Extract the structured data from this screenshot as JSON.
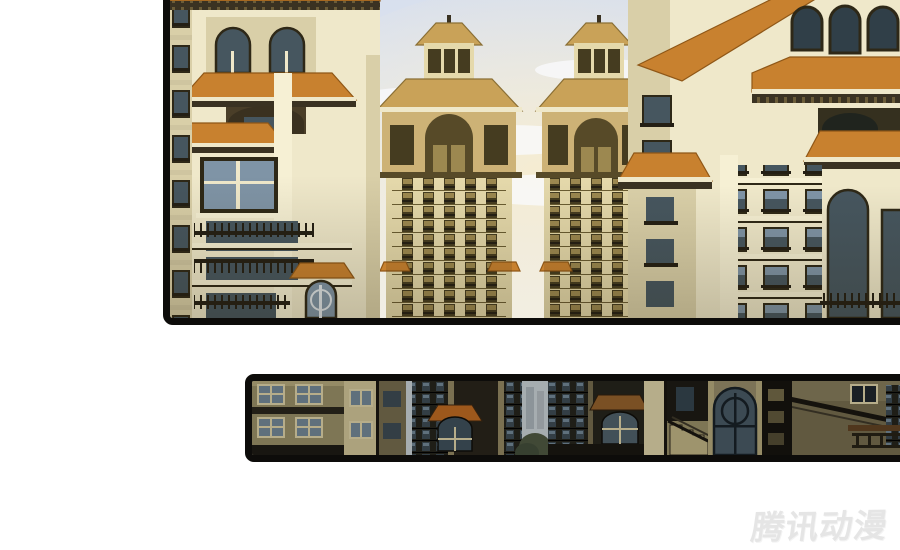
{
  "page": {
    "width": 900,
    "height": 550,
    "background": "#ffffff"
  },
  "watermark": {
    "text": "腾讯动漫"
  },
  "panels": {
    "top": {
      "description": "wide cityscape panel, twin golden high-rise towers between cream apartment buildings with orange tiled roofs"
    },
    "bottom": {
      "description": "dark street-level strip panel with building facades, entry canopy, arched door and stairs"
    }
  },
  "colors": {
    "page_bg": "#ffffff",
    "border": "#0d0c0a",
    "watermark": "#e5e5e5",
    "sky_top": "#d7dfee",
    "sky_mid": "#e7ebf2",
    "sky_low": "#f1efe8",
    "cloud": "#fafbfd",
    "glow": "#f6ecd0",
    "tower_wall": "#e5d9ab",
    "tower_wall_dark": "#cdb276",
    "tower_band": "#6a5c32",
    "tower_win": "#453c20",
    "tower_pane": "#9c8850",
    "tower_roof": "#c9a258",
    "tower_roof_edge": "#8a6f35",
    "tower_cornice": "#574a28",
    "wall_cream": "#efe8ca",
    "wall_shade": "#d9cfa8",
    "pier_bright": "#f6f0d4",
    "trim": "#2e2817",
    "roof_orange": "#c8812f",
    "roof_line": "#8f5717",
    "eave": "#3a3222",
    "glass": "#7f94a6",
    "glass_dark": "#46565f",
    "glass_deep": "#303f48",
    "rail": "#241f14",
    "strip_bg": "#14120d",
    "strip_wall": "#8f8660",
    "strip_wall_lt": "#c3b88e",
    "strip_pier": "#cfc49c",
    "strip_dark": "#23211a",
    "strip_glass": "#6b7f8c",
    "strip_glass_dim": "#39464e",
    "strip_mist": "#bcc4c8",
    "strip_trees": "#49523d",
    "strip_canopy": "#b2641f",
    "strip_canopy2": "#8a5a28",
    "strip_lit": "#6b6242"
  }
}
